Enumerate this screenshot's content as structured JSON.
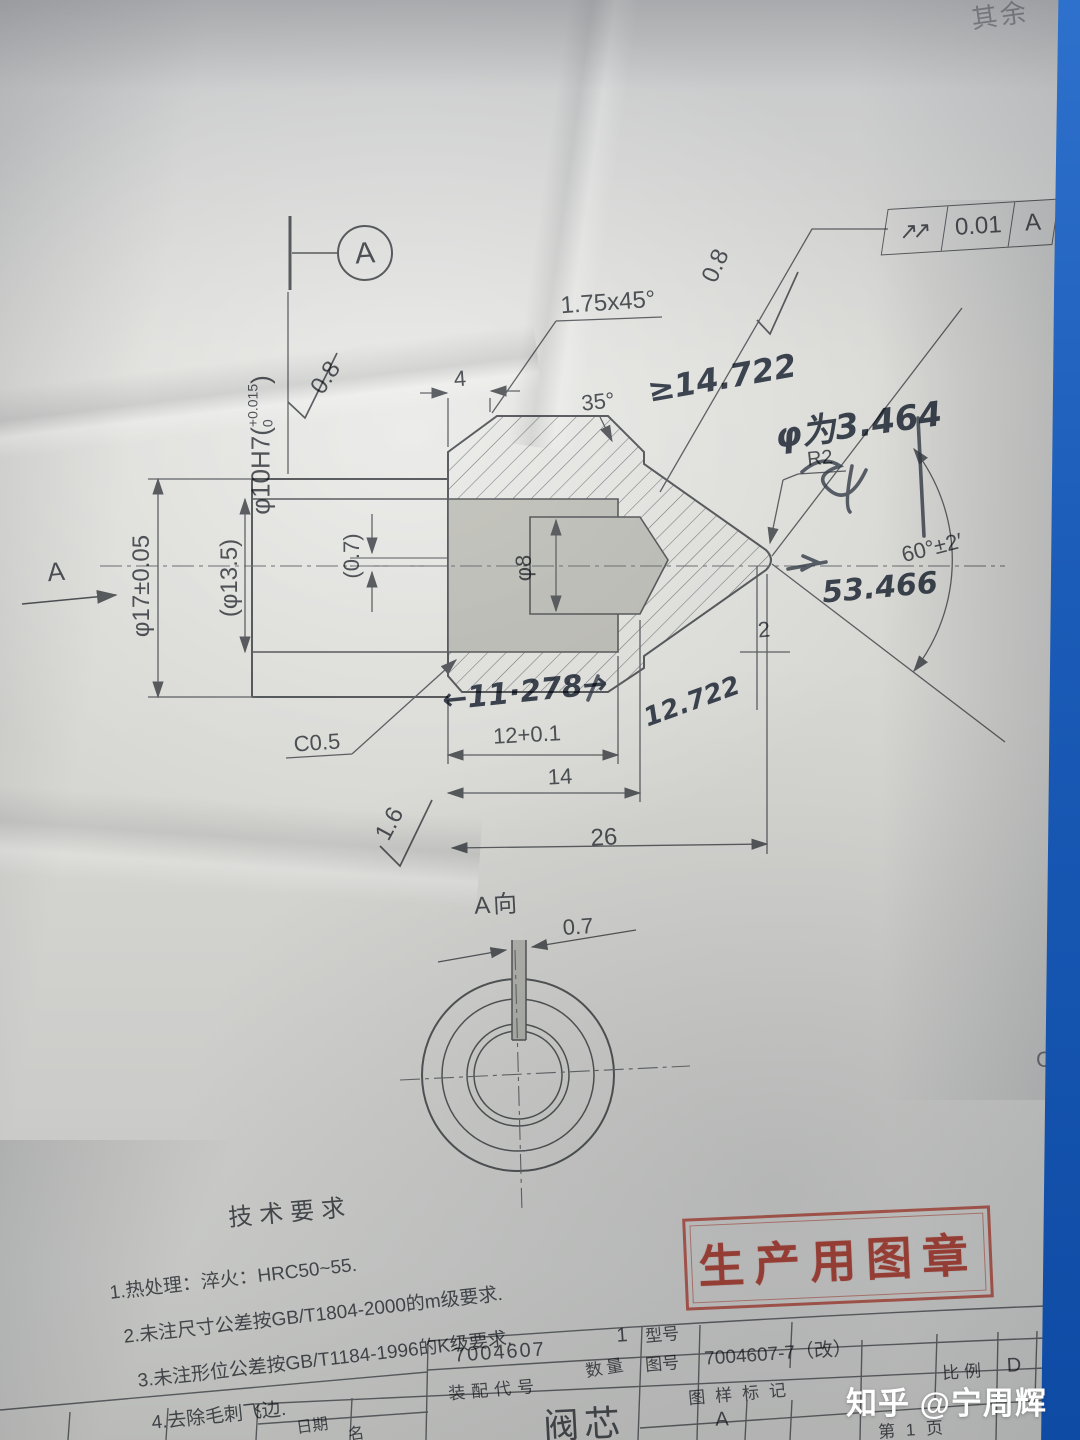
{
  "drawing": {
    "corner_note": "其余",
    "zone_c": "C",
    "datum_label": "A",
    "bore_callout": {
      "prefix": "φ10H7(",
      "upper": "+0.015",
      "lower": "0",
      "suffix": ")"
    },
    "roughness_top": "0.8",
    "roughness_cone": "0.8",
    "roughness_face": "1.6",
    "gdt": {
      "symbol": "↗↗",
      "value": "0.01",
      "datum": "A"
    },
    "chamfer_note": "1.75x45°",
    "angle_top": "35°",
    "dim_4": "4",
    "dim_dia17": "φ17±0.05",
    "dim_dia13_5": "(φ13.5)",
    "dim_slot_depth": "(0.7)",
    "dim_dia8": "φ8",
    "radius_tip": "R2",
    "angle_cone": "60°±2′",
    "dim_2": "2",
    "chamfer_c": "C0.5",
    "dim_12": "12+0.1",
    "dim_14": "14",
    "dim_26": "26",
    "view_direction_label": "A",
    "end_view_label": "A向",
    "end_view_slot": "0.7"
  },
  "handwritten": {
    "note_ge": "≥14.722",
    "note_dia": "φ为3.464",
    "note_53": "53.466",
    "note_11": "←11·278→",
    "note_12": "12.722"
  },
  "tech_requirements": {
    "title": "技术要求",
    "items": [
      "1.热处理：淬火：HRC50~55.",
      "2.未注尺寸公差按GB/T1804-2000的m级要求.",
      "3.未注形位公差按GB/T1184-1996的K级要求.",
      "4.去除毛刺飞边."
    ]
  },
  "stamp": {
    "text": "生产用图章"
  },
  "title_block": {
    "assembly_code_value": "7004607",
    "assembly_code_label": "装配代号",
    "quantity_value": "1",
    "quantity_label": "数量",
    "model_label": "型号",
    "drawing_no_label": "图号",
    "drawing_no_value": "7004607-7（改）",
    "mark_label": "图样标记",
    "scale_label": "比例",
    "zone_d": "D",
    "rev_letter": "A",
    "part_name": "阀芯",
    "page": "第 1 页",
    "date_label": "日期",
    "name_label": "名"
  },
  "watermark": "知乎 @宁周辉"
}
